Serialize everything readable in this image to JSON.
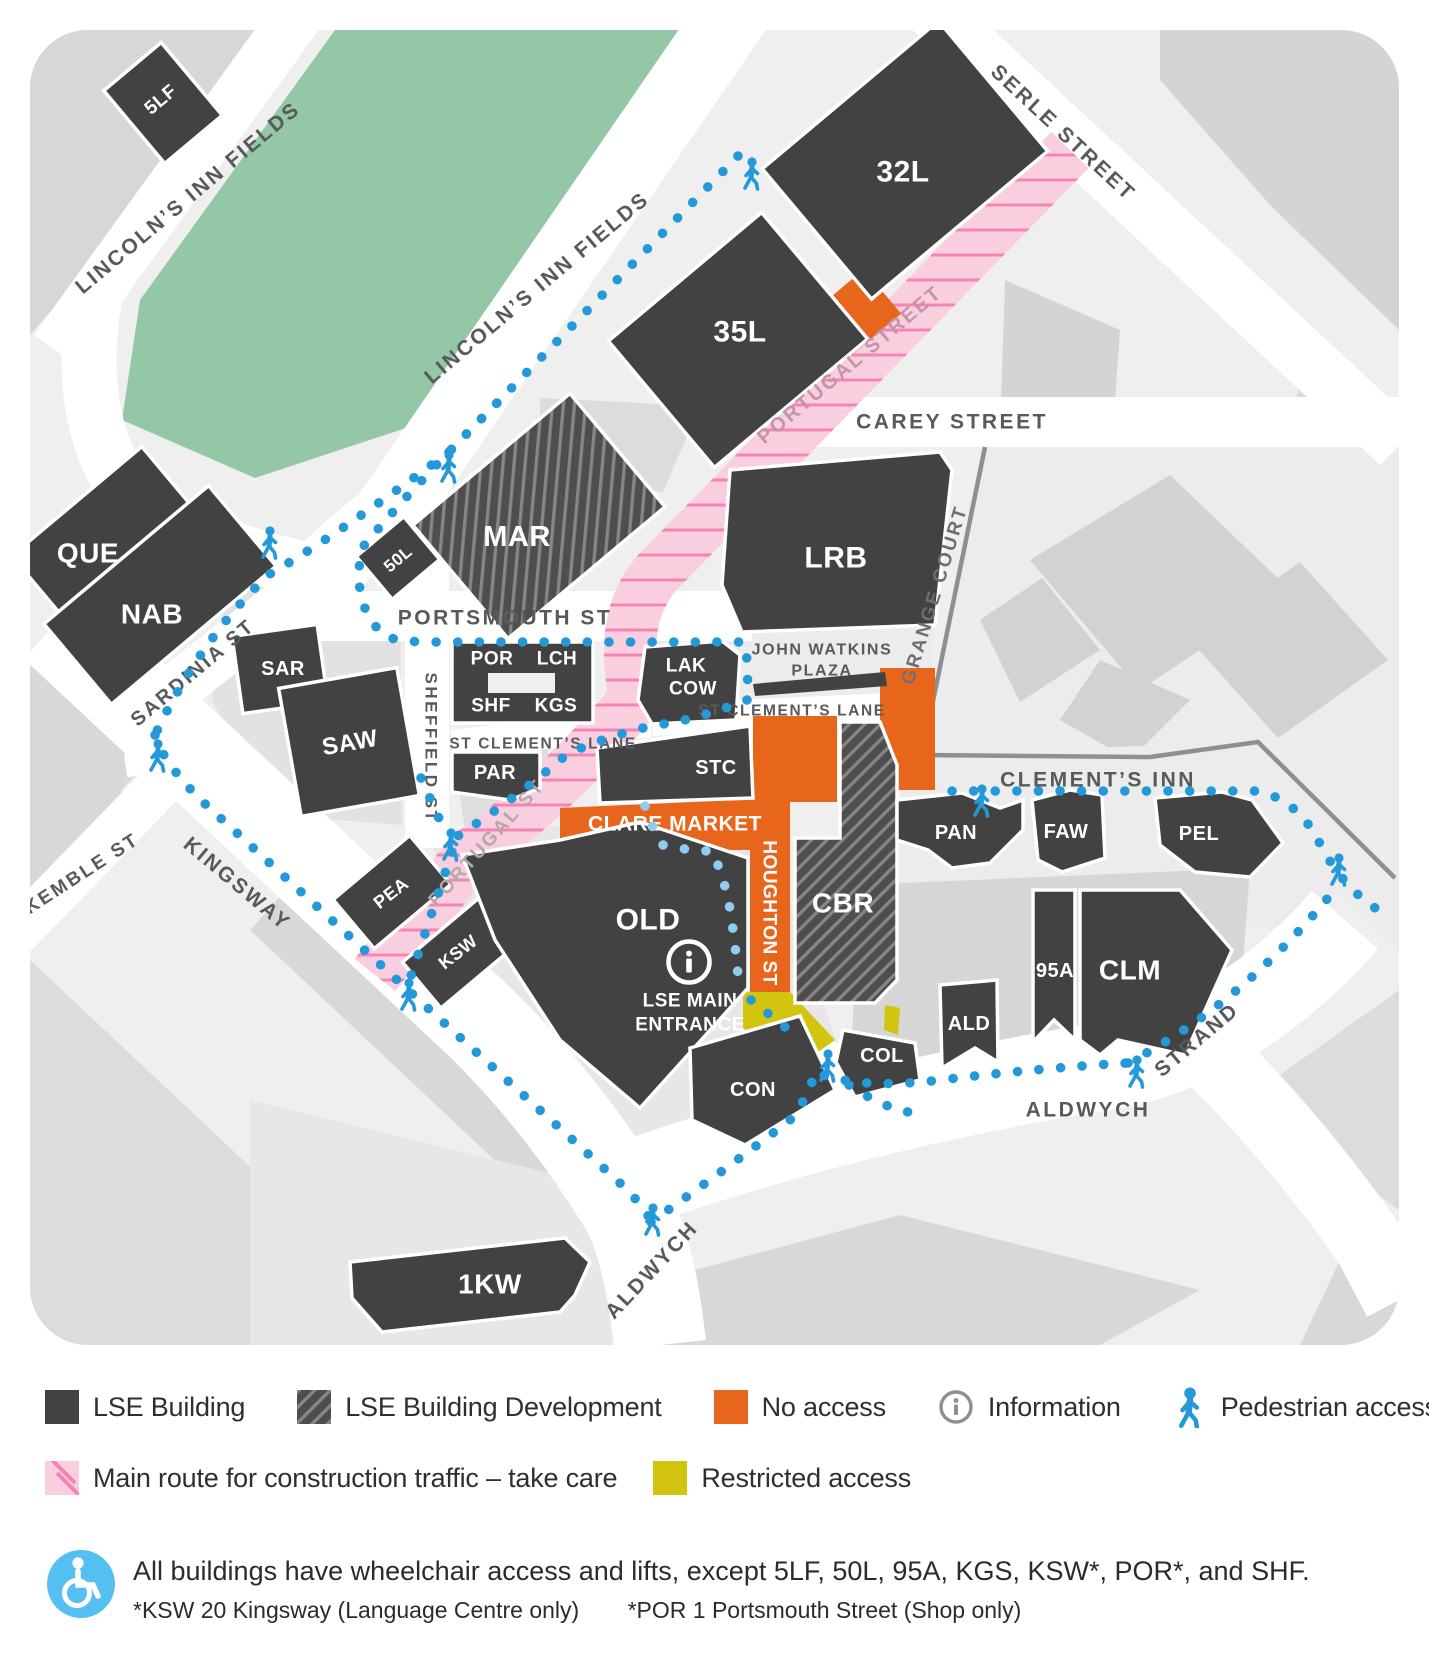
{
  "map": {
    "buildings": {
      "5lf": "5LF",
      "32l": "32L",
      "35l": "35L",
      "que": "QUE",
      "nab": "NAB",
      "mar": "MAR",
      "50l": "50L",
      "lrb": "LRB",
      "sar": "SAR",
      "saw": "SAW",
      "por": "POR",
      "lch": "LCH",
      "shf": "SHF",
      "kgs": "KGS",
      "lak": "LAK",
      "cow": "COW",
      "par": "PAR",
      "stc": "STC",
      "pea": "PEA",
      "ksw": "KSW",
      "old": "OLD",
      "cbr": "CBR",
      "pan": "PAN",
      "faw": "FAW",
      "pel": "PEL",
      "95a": "95A",
      "clm": "CLM",
      "ald": "ALD",
      "col": "COL",
      "con": "CON",
      "1kw": "1KW"
    },
    "streets": {
      "lincolns_inn_fields": "LINCOLN’S INN FIELDS",
      "serle": "SERLE STREET",
      "carey": "CAREY STREET",
      "portugal_street": "PORTUGAL STREET",
      "portugal_st": "PORTUGAL ST",
      "grange_court": "GRANGE COURT",
      "portsmouth": "PORTSMOUTH ST",
      "sheffield": "SHEFFIELD ST",
      "sardinia": "SARDINIA ST",
      "st_clements_lane": "ST CLEMENT’S LANE",
      "kingsway": "KINGSWAY",
      "kemble": "KEMBLE ST",
      "clements_inn": "CLEMENT’S INN",
      "aldwych": "ALDWYCH",
      "strand": "STRAND",
      "houghton": "HOUGHTON ST",
      "clare_market": "CLARE MARKET"
    },
    "labels": {
      "john_watkins_line1": "JOHN WATKINS",
      "john_watkins_line2": "PLAZA",
      "entrance_line1": "LSE MAIN",
      "entrance_line2": "ENTRANCE"
    },
    "colors": {
      "building": "#424242",
      "no_access": "#e8651c",
      "restricted": "#d3c50f",
      "construction_route": "#f9cfe0",
      "construction_stripe": "#f584b3",
      "pedestrian": "#2499d9",
      "pedestrian_light": "#8fcdef",
      "park": "#93c7a5"
    }
  },
  "legend": {
    "items": [
      {
        "label": "LSE Building"
      },
      {
        "label": "LSE Building Development"
      },
      {
        "label": "No access"
      },
      {
        "label": "Information"
      },
      {
        "label": "Pedestrian access"
      },
      {
        "label": "Main route for construction traffic – take care"
      },
      {
        "label": "Restricted access"
      }
    ]
  },
  "footer": {
    "note": "All buildings have wheelchair access and lifts, except 5LF, 50L, 95A, KGS, KSW*, POR*, and SHF.",
    "footnote_ksw": "*KSW 20 Kingsway (Language Centre only)",
    "footnote_por": "*POR 1 Portsmouth Street (Shop only)"
  }
}
